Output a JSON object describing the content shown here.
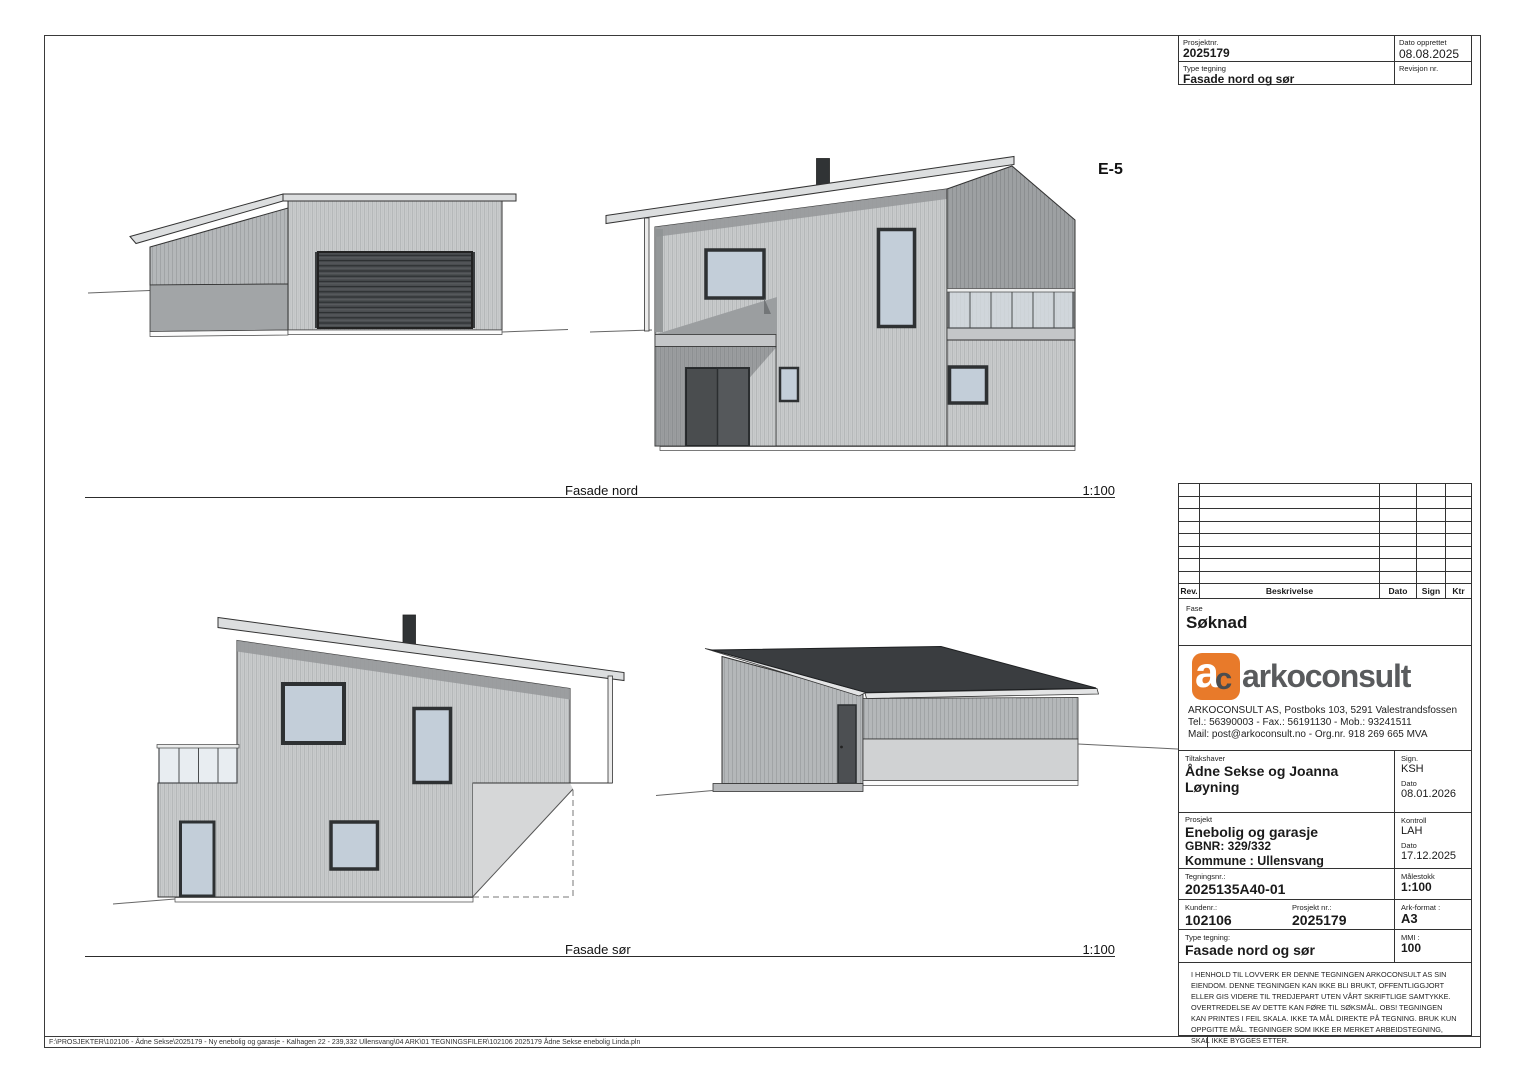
{
  "sheet": {
    "drawing_code": "E-5",
    "views": [
      {
        "label": "Fasade nord",
        "scale": "1:100"
      },
      {
        "label": "Fasade sør",
        "scale": "1:100"
      }
    ],
    "footer_path": "F:\\PROSJEKTER\\102106 - Ådne Sekse\\2025179 - Ny enebolig og garasje - Kalhagen 22 - 239,332 Ullensvang\\04 ARK\\01 TEGNINGSFILER\\102106 2025179 Ådne Sekse enebolig Linda.pln"
  },
  "title_block": {
    "top": {
      "prosjektnr_label": "Prosjektnr.",
      "prosjektnr": "2025179",
      "dato_opprettet_label": "Dato opprettet",
      "dato_opprettet": "08.08.2025",
      "type_tegning_label": "Type tegning",
      "type_tegning": "Fasade nord og sør",
      "revisjon_label": "Revisjon nr."
    },
    "revision_table": {
      "headers": [
        "Rev.",
        "Beskrivelse",
        "Dato",
        "Sign",
        "Ktr"
      ]
    },
    "fase_label": "Fase",
    "fase": "Søknad",
    "company": {
      "logo_a": "a",
      "logo_c": "c",
      "logo_text": "arkoconsult",
      "address_line1": "ARKOCONSULT AS, Postboks 103, 5291 Valestrandsfossen",
      "address_line2": "Tel.: 56390003 - Fax.: 56191130 - Mob.: 93241511",
      "address_line3": "Mail: post@arkoconsult.no - Org.nr. 918 269 665 MVA",
      "brand_orange": "#e87a2a",
      "brand_gray": "#595b5d"
    },
    "tiltakshaver_label": "Tiltakshaver",
    "tiltakshaver": "Ådne Sekse og Joanna Løyning",
    "sign_label": "Sign.",
    "sign": "KSH",
    "sign_dato_label": "Dato",
    "sign_dato": "08.01.2026",
    "prosjekt_label": "Prosjekt",
    "prosjekt": "Enebolig og garasje",
    "gbnr": "GBNR: 329/332",
    "kommune": "Kommune : Ullensvang",
    "kontroll_label": "Kontroll",
    "kontroll": "LAH",
    "kontroll_dato_label": "Dato",
    "kontroll_dato": "17.12.2025",
    "tegningsnr_label": "Tegningsnr.:",
    "tegningsnr": "2025135A40-01",
    "malestokk_label": "Målestokk",
    "malestokk": "1:100",
    "kundenr_label": "Kundenr.:",
    "kundenr": "102106",
    "prosjektnr2_label": "Prosjekt nr.:",
    "prosjektnr2": "2025179",
    "arkformat_label": "Ark-format :",
    "arkformat": "A3",
    "type_tegning2_label": "Type tegning:",
    "type_tegning2": "Fasade nord og sør",
    "mmi_label": "MMI :",
    "mmi": "100",
    "disclaimer": "I HENHOLD TIL LOVVERK ER DENNE TEGNINGEN ARKOCONSULT AS SIN EIENDOM. DENNE TEGNINGEN KAN IKKE BLI BRUKT, OFFENTLIGGJORT ELLER GIS VIDERE TIL TREDJEPART UTEN VÅRT SKRIFTLIGE SAMTYKKE. OVERTREDELSE AV DETTE KAN FØRE TIL SØKSMÅL. OBS! TEGNINGEN KAN PRINTES I FEIL SKALA. IKKE TA MÅL DIREKTE PÅ TEGNING. BRUK KUN OPPGITTE MÅL. TEGNINGER SOM IKKE ER MERKET ARBEIDSTEGNING, SKAL IKKE BYGGES ETTER."
  }
}
